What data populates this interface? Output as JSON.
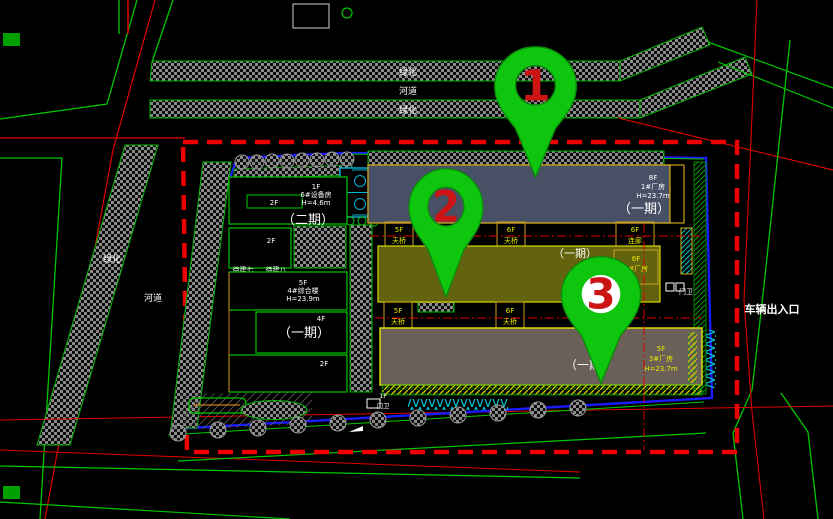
{
  "strips": {
    "green_top": "绿化",
    "river_top": "河道",
    "green_top2": "绿化",
    "green_left": "绿化",
    "river_left": "河道"
  },
  "site": {
    "entrance": "车辆出入口",
    "phase1": "（一期）",
    "phase2": "（二期）"
  },
  "b1": {
    "floors": "8F",
    "name": "1#厂房",
    "height": "H=23.7m",
    "phase": "（一期）"
  },
  "b2": {
    "floors": "6F",
    "name": "2#厂房",
    "phase": "（一期）"
  },
  "b3": {
    "floors": "5F",
    "name": "3#厂房",
    "height": "H=23.7m",
    "phase": "（一期）"
  },
  "b4": {
    "floors": "5F",
    "name": "4#综合楼",
    "height": "H=23.9m",
    "phase": "（一期）",
    "annex_floors": "4F",
    "lower_floors": "2F"
  },
  "b6": {
    "floors": "1F",
    "name": "6#设备房",
    "height": "H=4.6m",
    "annex_floors": "2F",
    "neighbor_floors": "2F",
    "phase": "（二期）"
  },
  "pending": {
    "p7": "待建七",
    "p8": "待建八"
  },
  "connectors": {
    "c1f": "5F",
    "c1n": "天桥",
    "c2f": "6F",
    "c2n": "天桥",
    "c3f": "6F",
    "c3n": "连廊",
    "c4f": "5F",
    "c4n": "天桥",
    "c5f": "6F",
    "c5n": "天桥",
    "c6f": "6F",
    "c6n": "天桥"
  },
  "gatehouse": {
    "floors": "1F",
    "label": "门卫"
  },
  "gate2": {
    "label": "门卫"
  },
  "pins": {
    "p1": "1",
    "p2": "2",
    "p3": "3"
  },
  "colors": {
    "background": "#000000",
    "road_green": "#00c800",
    "thin_red": "#e00000",
    "boundary_red_dashed": "#ee0000",
    "parcel_blue": "#1a1aff",
    "cyan": "#00c8d2",
    "building1_fill": "#475064",
    "building2_fill": "#63630e",
    "building3_fill": "#6b6057",
    "building_border_orange": "#c8a01e",
    "building_border_yellow": "#e8e800",
    "pin_green": "#0fc60f",
    "pin_number_red": "#cc1414",
    "label_white": "#ffffff",
    "label_yellow": "#e8e800"
  }
}
